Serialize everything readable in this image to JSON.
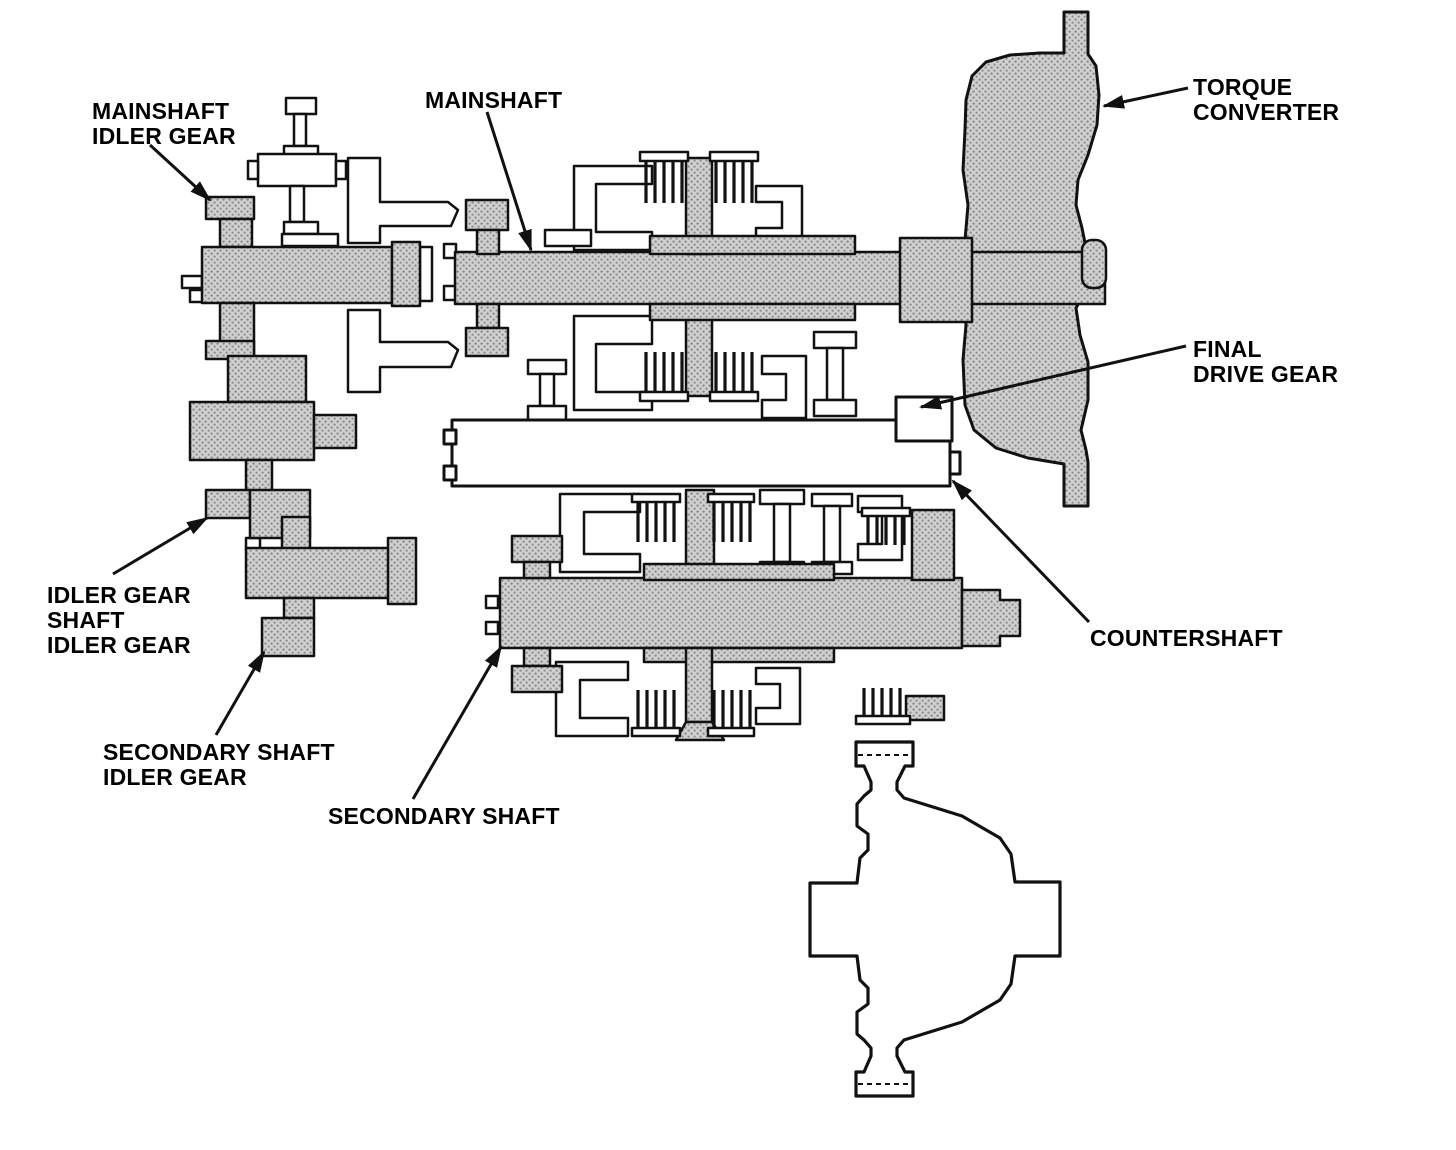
{
  "labels": [
    {
      "id": "mainshaft-idler-gear",
      "lines": [
        "MAINSHAFT",
        "IDLER GEAR"
      ]
    },
    {
      "id": "mainshaft",
      "lines": [
        "MAINSHAFT"
      ]
    },
    {
      "id": "torque-converter",
      "lines": [
        "TORQUE",
        "CONVERTER"
      ]
    },
    {
      "id": "final-drive-gear",
      "lines": [
        "FINAL",
        "DRIVE GEAR"
      ]
    },
    {
      "id": "idler-gear-shaft",
      "lines": [
        "IDLER GEAR",
        "SHAFT",
        "IDLER GEAR"
      ]
    },
    {
      "id": "secondary-shaft-idler-gear",
      "lines": [
        "SECONDARY SHAFT",
        "IDLER GEAR"
      ]
    },
    {
      "id": "secondary-shaft",
      "lines": [
        "SECONDARY SHAFT"
      ]
    },
    {
      "id": "countershaft",
      "lines": [
        "COUNTERSHAFT"
      ]
    }
  ],
  "colors": {
    "background": "#ffffff",
    "line": "#111111",
    "metal_fill": "#b9b9b9",
    "label_text": "#000000"
  }
}
